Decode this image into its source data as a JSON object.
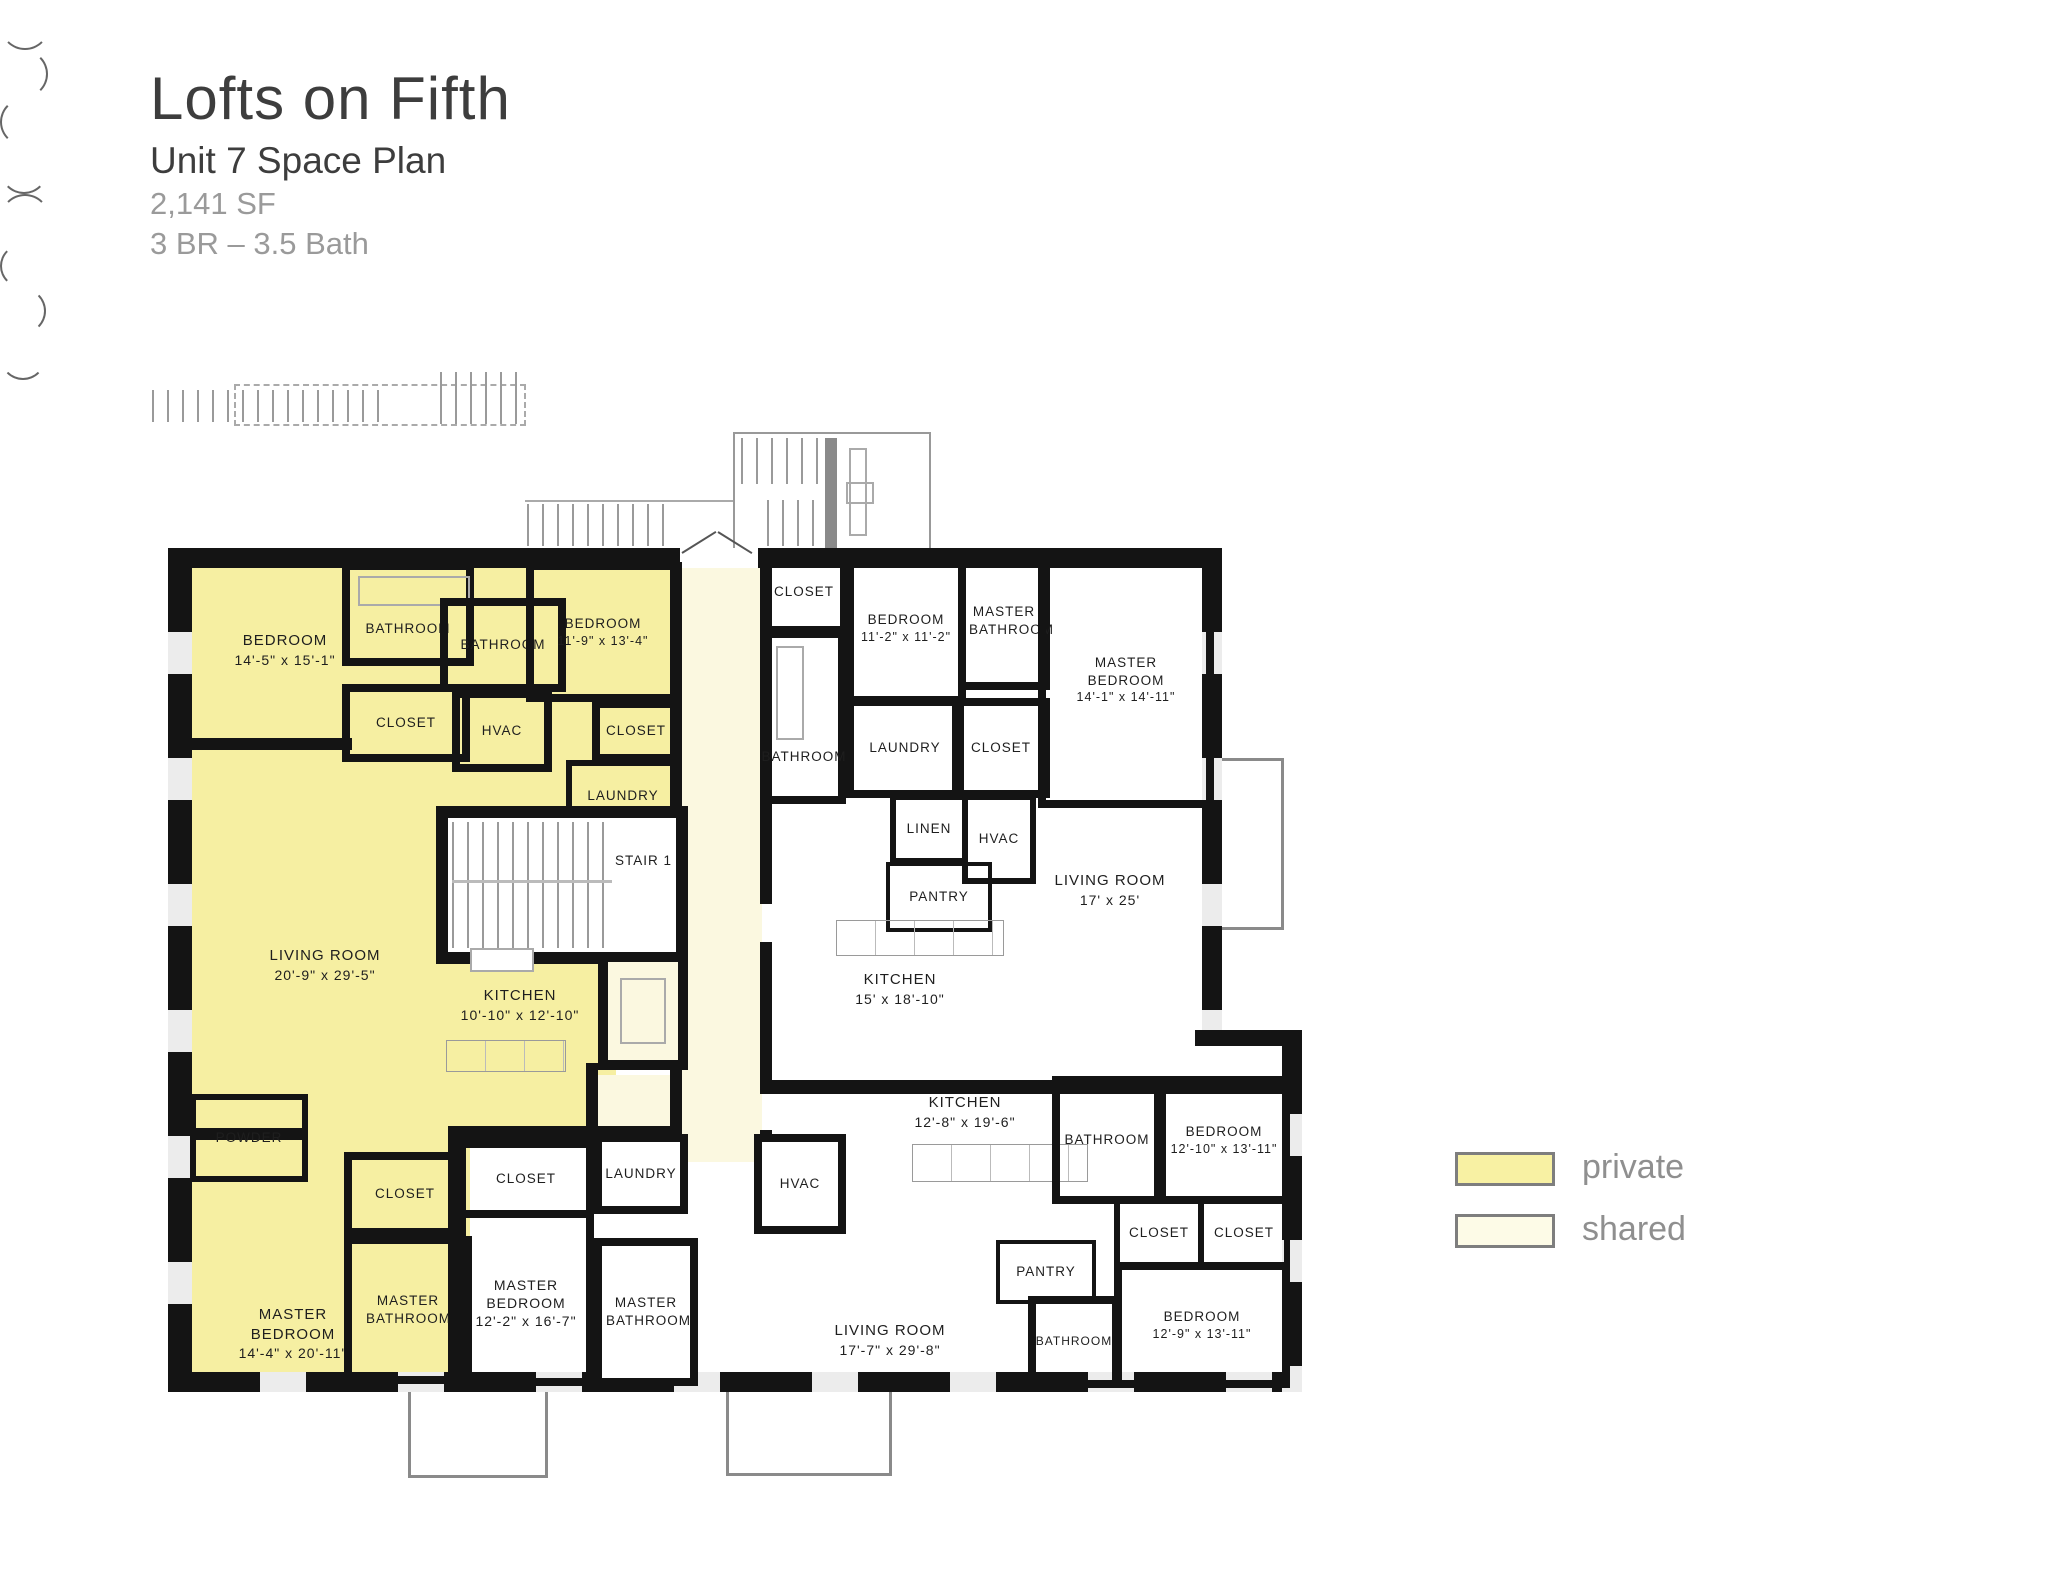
{
  "header": {
    "title": "Lofts on Fifth",
    "subtitle": "Unit 7 Space Plan",
    "area": "2,141 SF",
    "config": "3 BR – 3.5 Bath"
  },
  "legend": {
    "private": {
      "label": "private",
      "color": "#F8F1A3"
    },
    "shared": {
      "label": "shared",
      "color": "#FDFBE7"
    }
  },
  "colors": {
    "private_fill": "#F6EFA2",
    "shared_fill": "#FBF8E0",
    "wall": "#141414"
  },
  "rooms": {
    "bedroom_1": {
      "label": "BEDROOM",
      "dim": "14'-5\" x 15'-1\""
    },
    "bathroom_1": {
      "label": "BATHROOM"
    },
    "bathroom_2": {
      "label": "BATHROOM"
    },
    "bedroom_2": {
      "label": "BEDROOM",
      "dim": "11'-9\" x 13'-4\""
    },
    "closet_1": {
      "label": "CLOSET"
    },
    "hvac_1": {
      "label": "HVAC"
    },
    "closet_2": {
      "label": "CLOSET"
    },
    "laundry_1": {
      "label": "LAUNDRY"
    },
    "stair_1": {
      "label": "STAIR 1"
    },
    "living_room_1": {
      "label": "LIVING ROOM",
      "dim": "20'-9\" x 29'-5\""
    },
    "kitchen_1": {
      "label": "KITCHEN",
      "dim": "10'-10\" x 12'-10\""
    },
    "powder": {
      "label": "POWDER"
    },
    "closet_3": {
      "label": "CLOSET"
    },
    "master_bedroom_1": {
      "label": "MASTER BEDROOM",
      "dim": "14'-4\" x 20'-11\""
    },
    "master_bathroom_1": {
      "label": "MASTER BATHROOM"
    },
    "closet_4": {
      "label": "CLOSET"
    },
    "bedroom_3": {
      "label": "BEDROOM",
      "dim": "11'-2\" x 11'-2\""
    },
    "master_bathroom_2": {
      "label": "MASTER BATHROOM"
    },
    "master_bedroom_2": {
      "label": "MASTER BEDROOM",
      "dim": "14'-1\" x 14'-11\""
    },
    "bathroom_3": {
      "label": "BATHROOM"
    },
    "laundry_2": {
      "label": "LAUNDRY"
    },
    "closet_5": {
      "label": "CLOSET"
    },
    "linen": {
      "label": "LINEN"
    },
    "hvac_2": {
      "label": "HVAC"
    },
    "pantry_1": {
      "label": "PANTRY"
    },
    "living_room_2": {
      "label": "LIVING ROOM",
      "dim": "17' x 25'"
    },
    "kitchen_2": {
      "label": "KITCHEN",
      "dim": "15' x 18'-10\""
    },
    "closet_6": {
      "label": "CLOSET"
    },
    "master_bedroom_3": {
      "label": "MASTER BEDROOM",
      "dim": "12'-2\" x 16'-7\""
    },
    "laundry_3": {
      "label": "LAUNDRY"
    },
    "master_bathroom_3": {
      "label": "MASTER BATHROOM"
    },
    "hvac_3": {
      "label": "HVAC"
    },
    "kitchen_3": {
      "label": "KITCHEN",
      "dim": "12'-8\" x 19'-6\""
    },
    "bathroom_4": {
      "label": "BATHROOM"
    },
    "bedroom_4": {
      "label": "BEDROOM",
      "dim": "12'-10\" x 13'-11\""
    },
    "closet_7": {
      "label": "CLOSET"
    },
    "closet_8": {
      "label": "CLOSET"
    },
    "pantry_2": {
      "label": "PANTRY"
    },
    "living_room_3": {
      "label": "LIVING ROOM",
      "dim": "17'-7\" x 29'-8\""
    },
    "bedroom_5": {
      "label": "BEDROOM",
      "dim": "12'-9\" x 13'-11\""
    },
    "bathroom_5": {
      "label": "BATHROOM"
    }
  }
}
